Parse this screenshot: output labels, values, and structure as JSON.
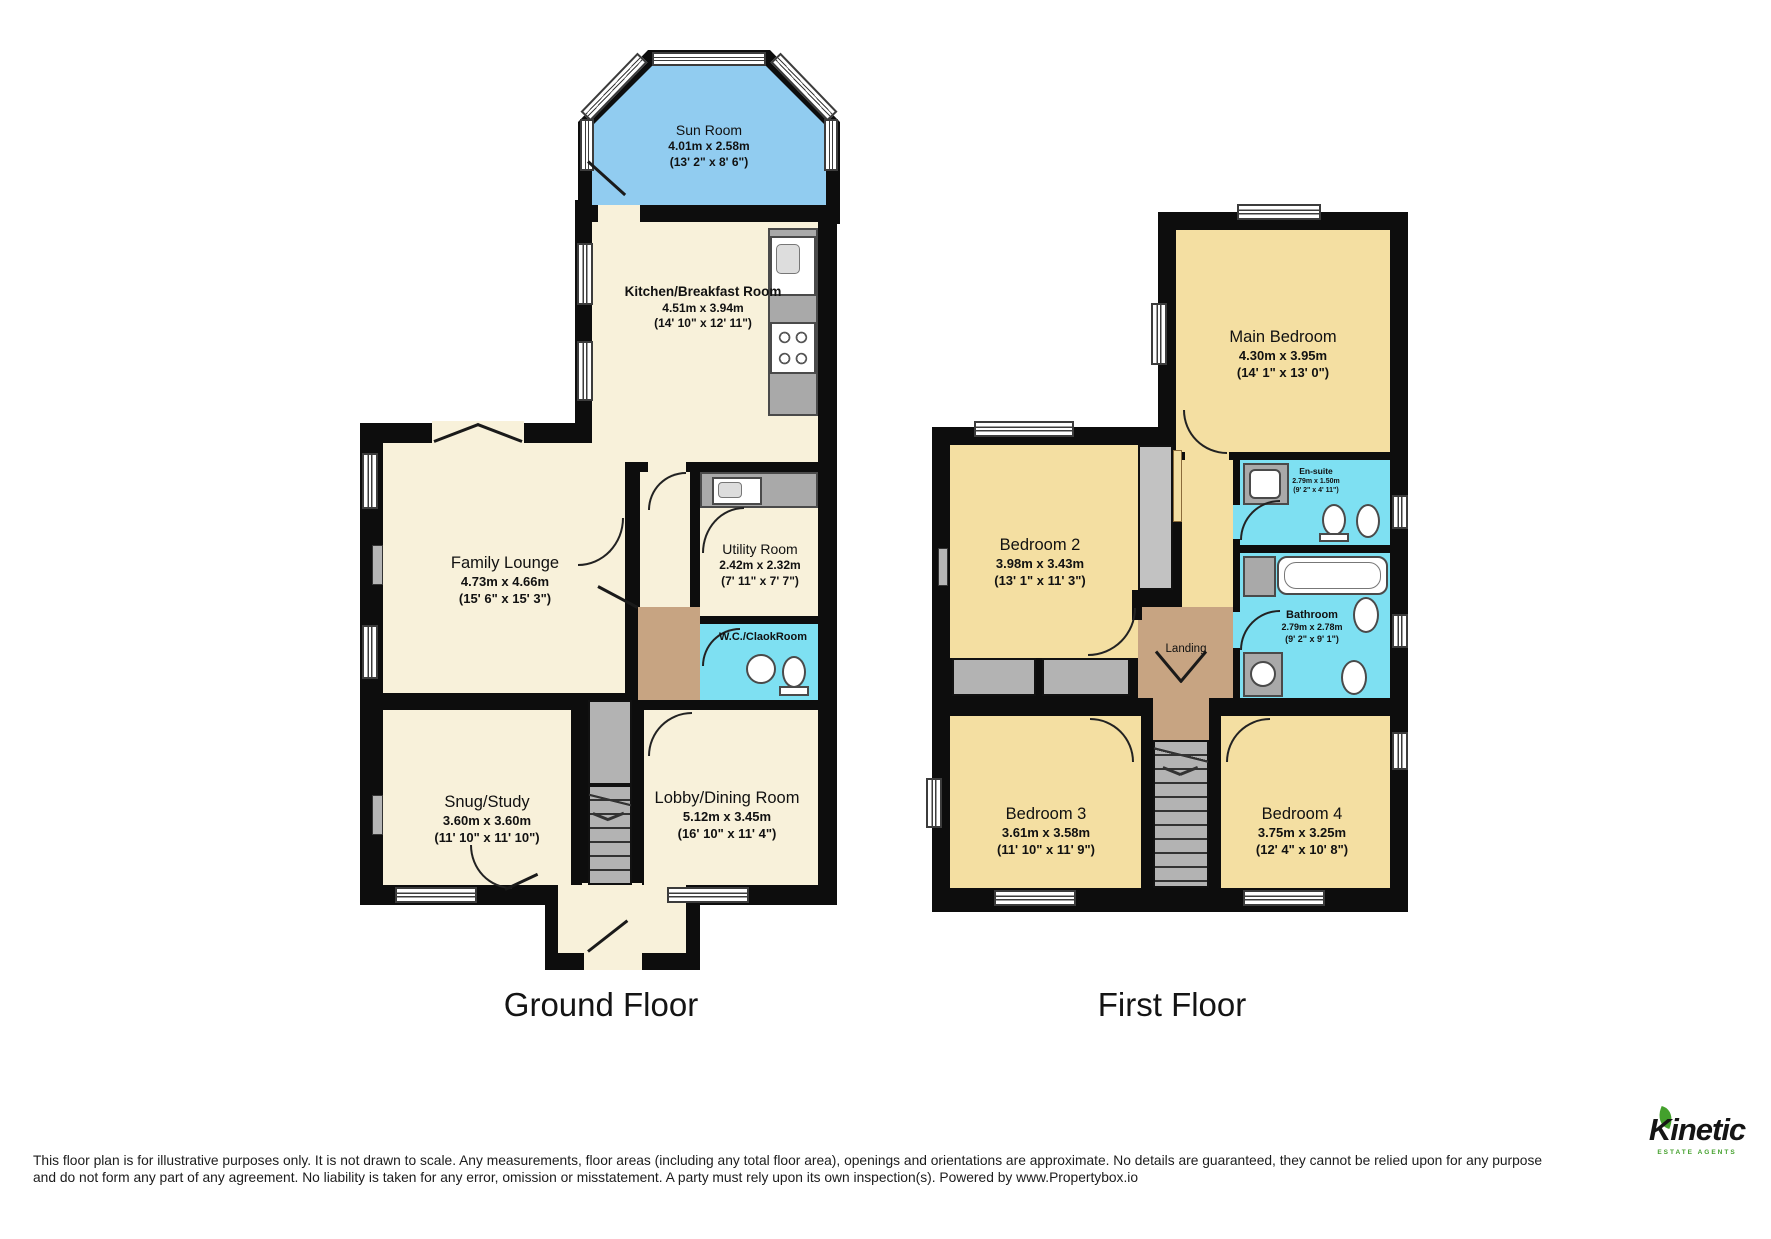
{
  "floors": {
    "ground": {
      "label": "Ground Floor",
      "rooms": {
        "sun_room": {
          "name": "Sun Room",
          "dims_m": "4.01m x 2.58m",
          "dims_ft": "(13' 2\" x 8' 6\")"
        },
        "kitchen": {
          "name": "Kitchen/Breakfast Room",
          "dims_m": "4.51m x 3.94m",
          "dims_ft": "(14' 10\" x 12' 11\")"
        },
        "family_lounge": {
          "name": "Family Lounge",
          "dims_m": "4.73m x 4.66m",
          "dims_ft": "(15' 6\" x 15' 3\")"
        },
        "utility": {
          "name": "Utility Room",
          "dims_m": "2.42m x 2.32m",
          "dims_ft": "(7' 11\" x 7' 7\")"
        },
        "wc": {
          "name": "W.C./ClaokRoom"
        },
        "snug": {
          "name": "Snug/Study",
          "dims_m": "3.60m x 3.60m",
          "dims_ft": "(11' 10\" x 11' 10\")"
        },
        "lobby": {
          "name": "Lobby/Dining Room",
          "dims_m": "5.12m x 3.45m",
          "dims_ft": "(16' 10\" x 11' 4\")"
        }
      }
    },
    "first": {
      "label": "First Floor",
      "rooms": {
        "main_bedroom": {
          "name": "Main Bedroom",
          "dims_m": "4.30m x 3.95m",
          "dims_ft": "(14' 1\" x 13' 0\")"
        },
        "bedroom2": {
          "name": "Bedroom 2",
          "dims_m": "3.98m x 3.43m",
          "dims_ft": "(13' 1\" x 11' 3\")"
        },
        "ensuite": {
          "name": "En-suite",
          "dims_m": "2.79m x 1.50m",
          "dims_ft": "(9' 2\" x 4' 11\")"
        },
        "bathroom": {
          "name": "Bathroom",
          "dims_m": "2.79m x 2.78m",
          "dims_ft": "(9' 2\" x 9' 1\")"
        },
        "landing": {
          "name": "Landing"
        },
        "bedroom3": {
          "name": "Bedroom 3",
          "dims_m": "3.61m x 3.58m",
          "dims_ft": "(11' 10\" x 11' 9\")"
        },
        "bedroom4": {
          "name": "Bedroom 4",
          "dims_m": "3.75m x 3.25m",
          "dims_ft": "(12' 4\" x 10' 8\")"
        }
      }
    }
  },
  "footer": {
    "disclaimer": "This floor plan is for illustrative purposes only. It is not drawn to scale. Any measurements, floor areas (including any total floor area), openings and orientations are approximate. No details are guaranteed, they cannot be relied upon for any purpose and do not form any part of any agreement. No liability is taken for any error, omission or misstatement. A party must rely upon its own inspection(s). Powered by www.Propertybox.io"
  },
  "logo": {
    "name": "Kinetic",
    "tagline": "ESTATE AGENTS"
  },
  "colors": {
    "wall": "#0d0d0d",
    "ground_room_fill": "#f8f1da",
    "bedroom_fill": "#f4dfa2",
    "sun_room_fill": "#91ccf0",
    "bathroom_fill": "#7ee0f2",
    "hall_fill": "#c7a482",
    "stairs_fill": "#b3b3b3",
    "logo_green": "#43a02c"
  }
}
